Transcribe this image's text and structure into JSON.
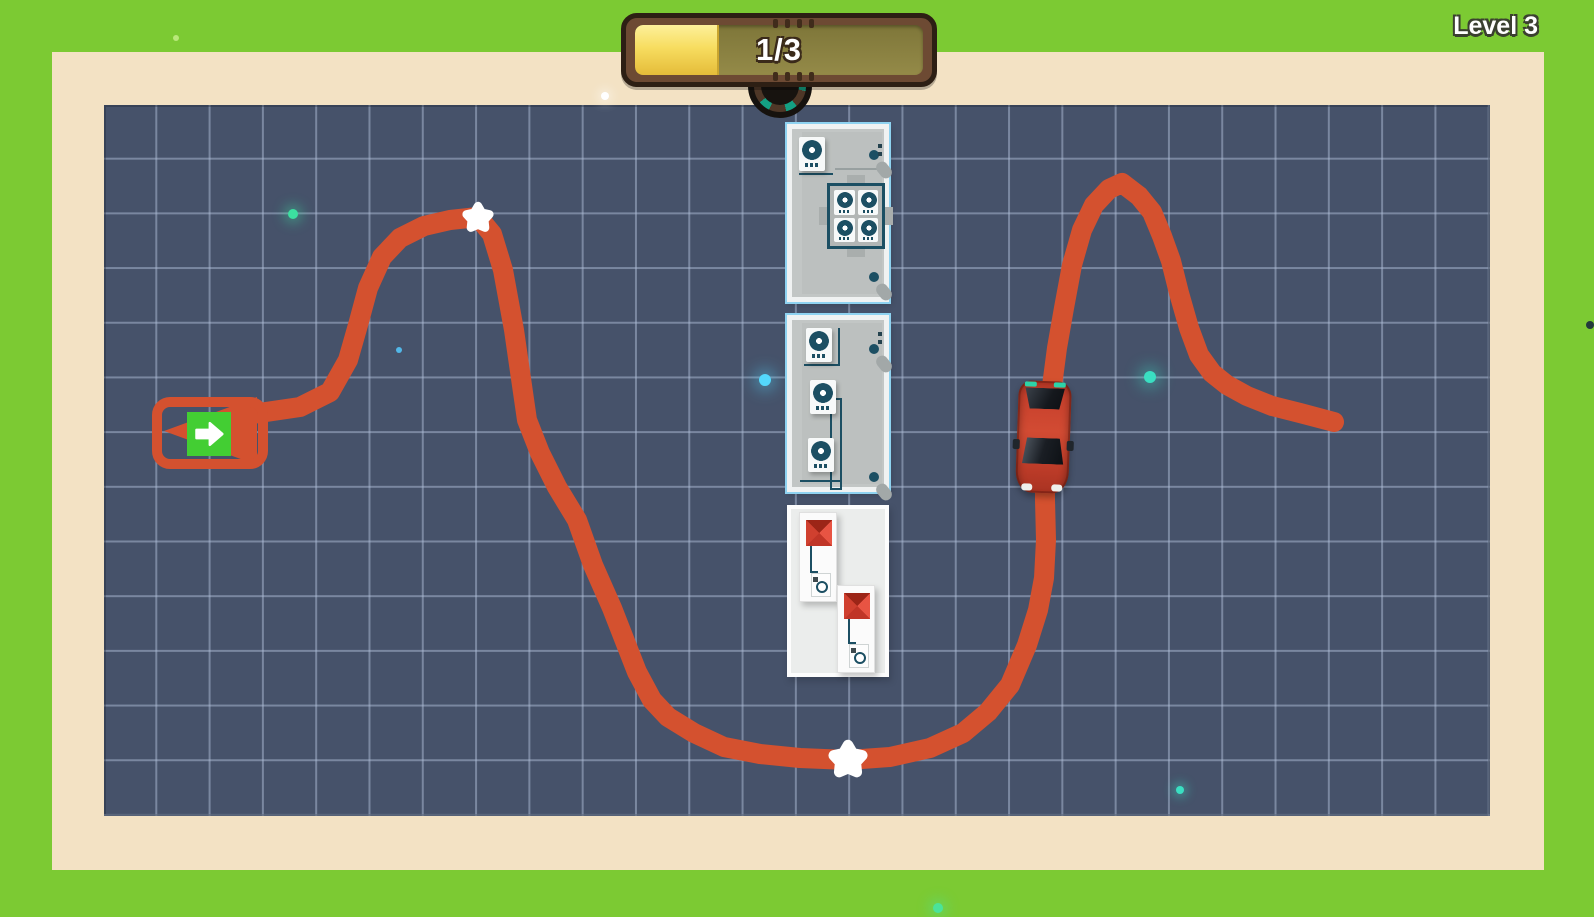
{
  "hud": {
    "level_label": "Level 3",
    "progress_label": "1/3",
    "progress": {
      "current": 1,
      "total": 3,
      "fill_percent": 29
    }
  },
  "colors": {
    "frame_green": "#7cca33",
    "mat_cream": "#f3e2c4",
    "field_navy": "#46526a",
    "path_red": "#d4512f",
    "exit_pad_green": "#43ce33",
    "star_white": "#ffffff",
    "car_red": "#c7402c",
    "bar_frame_brown": "#6d4a33",
    "bar_track_olive": "#948a48",
    "bar_fill_yellow": "#f2cf45",
    "gauge_teal": "#14a083"
  },
  "game": {
    "path": {
      "stroke_width": 20,
      "points": [
        [
          252,
          414
        ],
        [
          300,
          407
        ],
        [
          330,
          392
        ],
        [
          348,
          360
        ],
        [
          358,
          325
        ],
        [
          368,
          288
        ],
        [
          382,
          257
        ],
        [
          400,
          238
        ],
        [
          424,
          226
        ],
        [
          450,
          220
        ],
        [
          478,
          217
        ],
        [
          492,
          234
        ],
        [
          503,
          270
        ],
        [
          514,
          330
        ],
        [
          527,
          420
        ],
        [
          540,
          453
        ],
        [
          557,
          487
        ],
        [
          577,
          520
        ],
        [
          593,
          565
        ],
        [
          612,
          608
        ],
        [
          637,
          672
        ],
        [
          652,
          700
        ],
        [
          668,
          717
        ],
        [
          694,
          733
        ],
        [
          724,
          747
        ],
        [
          760,
          754
        ],
        [
          800,
          758
        ],
        [
          848,
          760
        ],
        [
          890,
          757
        ],
        [
          930,
          748
        ],
        [
          963,
          733
        ],
        [
          988,
          712
        ],
        [
          1010,
          685
        ],
        [
          1027,
          645
        ],
        [
          1038,
          610
        ],
        [
          1044,
          578
        ],
        [
          1046,
          540
        ],
        [
          1045,
          500
        ],
        [
          1045,
          460
        ],
        [
          1048,
          420
        ],
        [
          1052,
          386
        ],
        [
          1057,
          348
        ],
        [
          1064,
          308
        ],
        [
          1072,
          265
        ],
        [
          1082,
          230
        ],
        [
          1094,
          205
        ],
        [
          1109,
          189
        ],
        [
          1122,
          183
        ],
        [
          1139,
          196
        ],
        [
          1152,
          212
        ],
        [
          1162,
          236
        ],
        [
          1171,
          261
        ],
        [
          1179,
          293
        ],
        [
          1189,
          328
        ],
        [
          1199,
          355
        ],
        [
          1212,
          373
        ],
        [
          1227,
          385
        ],
        [
          1247,
          396
        ],
        [
          1272,
          406
        ],
        [
          1300,
          413
        ],
        [
          1334,
          422
        ]
      ],
      "arrowhead": [
        [
          164,
          431
        ],
        [
          257,
          397
        ],
        [
          257,
          465
        ]
      ]
    },
    "stars": [
      {
        "x": 478,
        "y": 218,
        "r": 12
      },
      {
        "x": 848,
        "y": 760,
        "r": 15
      }
    ],
    "particles": [
      {
        "x": 605,
        "y": 96,
        "r": 4,
        "color": "#ffffff",
        "glow": true
      },
      {
        "x": 176,
        "y": 38,
        "r": 3,
        "color": "#b9e87a",
        "glow": false
      },
      {
        "x": 293,
        "y": 214,
        "r": 5,
        "color": "#3ce0a0",
        "glow": true
      },
      {
        "x": 399,
        "y": 350,
        "r": 3,
        "color": "#52b7e8",
        "glow": false
      },
      {
        "x": 765,
        "y": 380,
        "r": 6,
        "color": "#54d8fc",
        "glow": true
      },
      {
        "x": 1150,
        "y": 377,
        "r": 6,
        "color": "#3adfc2",
        "glow": true
      },
      {
        "x": 1180,
        "y": 790,
        "r": 4,
        "color": "#3adfc2",
        "glow": true
      },
      {
        "x": 938,
        "y": 908,
        "r": 5,
        "color": "#4be39a",
        "glow": true
      },
      {
        "x": 1590,
        "y": 325,
        "r": 4,
        "color": "#233a3c",
        "glow": false
      }
    ]
  }
}
